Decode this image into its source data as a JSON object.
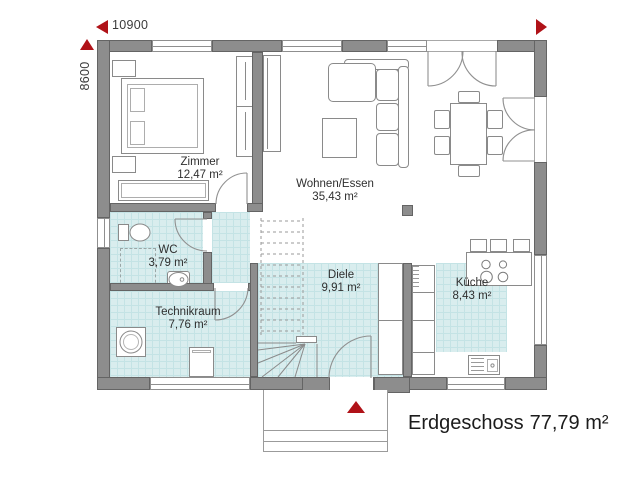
{
  "title": {
    "label": "Erdgeschoss",
    "area": "77,79 m²"
  },
  "dimensions": {
    "width_label": "10900",
    "height_label": "8600"
  },
  "rooms": [
    {
      "id": "zimmer",
      "name": "Zimmer",
      "area": "12,47 m²"
    },
    {
      "id": "wohnen",
      "name": "Wohnen/Essen",
      "area": "35,43 m²"
    },
    {
      "id": "wc",
      "name": "WC",
      "area": "3,79 m²"
    },
    {
      "id": "technikraum",
      "name": "Technikraum",
      "area": "7,76 m²"
    },
    {
      "id": "diele",
      "name": "Diele",
      "area": "9,91 m²"
    },
    {
      "id": "kueche",
      "name": "Küche",
      "area": "8,43 m²"
    }
  ],
  "icons": {
    "dim_arrow_left": "red triangle pointing left",
    "dim_arrow_up": "red triangle pointing up",
    "orientation_arrow": "red triangle pointing right",
    "entrance_arrow": "red triangle pointing up"
  },
  "colors": {
    "wall": "#8d8d8d",
    "wall_edge": "#646464",
    "tile": "#d9edee",
    "tile_grid": "#c4e3e5",
    "accent_red": "#b01218",
    "text": "#2f2f2f"
  }
}
